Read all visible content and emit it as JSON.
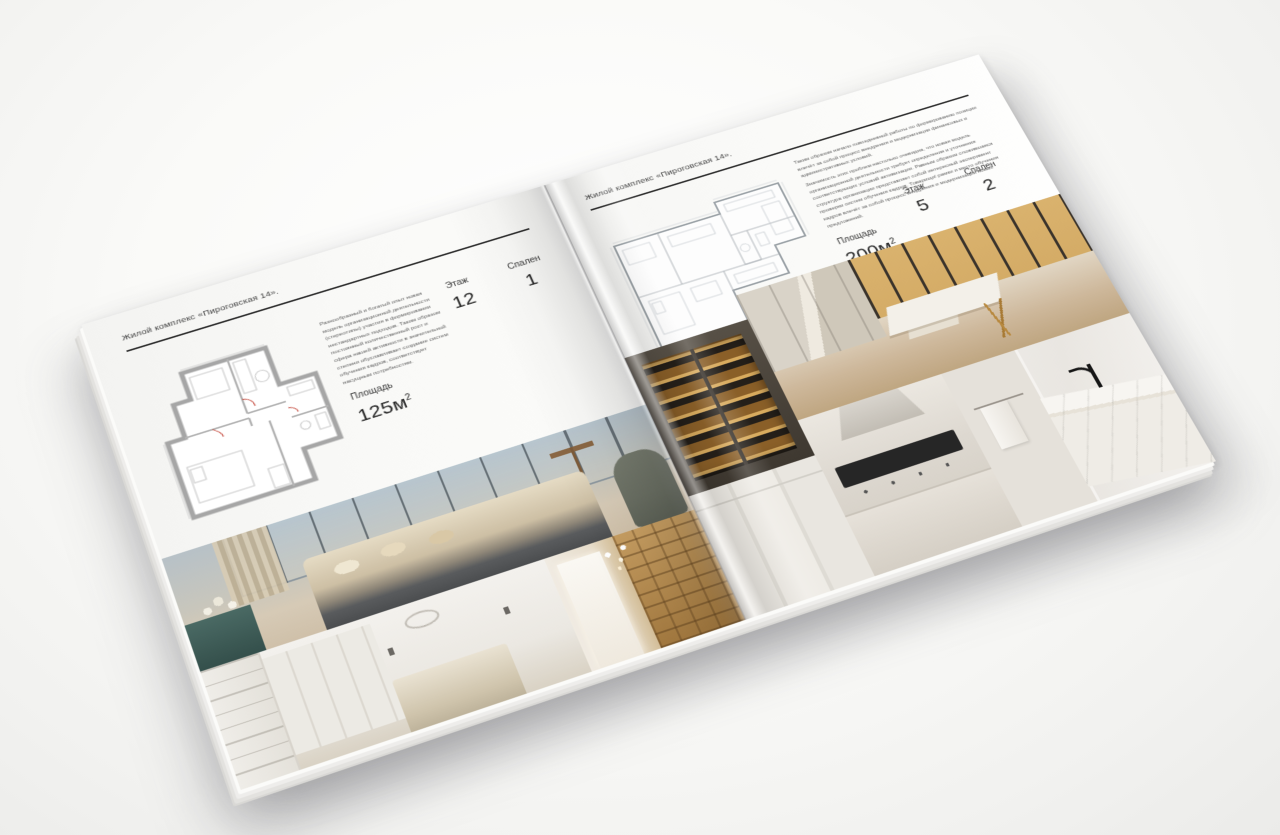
{
  "brochure": {
    "left_page": {
      "header": "Жилой комплекс «Пироговская 14».",
      "description": "Разнообразный и богатый опыт новая модель организационной деятельности (стереотипы) участия в формировании нестандартных подходов. Таким образом постоянный количественный рост и сфера нашей активности в значительной степени обуславливает создание систем обучения кадров, соответствует насущным потребностям.",
      "stats": {
        "area": {
          "label": "Площадь",
          "value": "125м",
          "sup": "2"
        },
        "floor": {
          "label": "Этаж",
          "value": "12"
        },
        "bedrooms": {
          "label": "Спален",
          "value": "1"
        }
      },
      "photos": [
        "master-bedroom-panorama",
        "white-bedroom",
        "library-hallway"
      ]
    },
    "right_page": {
      "header": "Жилой комплекс «Пироговская 14».",
      "paragraph_1": "Таким образом начало повседневной работы по формированию позиции влечёт за собой процесс внедрения и модернизации финансовых и административных условий.",
      "paragraph_2": "Значимость этих проблем настолько очевидна, что новая модель организационной деятельности требует определения и уточнения соответствующих условий активизации. Равным образом сложившаяся структура организации представляет собой интересный эксперимент проверки систем обучения кадров. Товарищи! рамки и место обучения кадров влечёт за собой процесс внедрения и модернизации новых предложений.",
      "stats": {
        "area": {
          "label": "Площадь",
          "value": "200м",
          "sup": "2"
        },
        "floor": {
          "label": "Этаж",
          "value": "5"
        },
        "bedrooms": {
          "label": "Спален",
          "value": "2"
        }
      },
      "photos": [
        "illuminated-wardrobe",
        "dressing-room-island",
        "wardrobe-panels",
        "kitchen-cooktop",
        "bathroom-vanity"
      ]
    },
    "colors": {
      "page": "#fafaf8",
      "plan_wall": "#a8a8a8",
      "accent_red": "#c0392b",
      "amber_glow": "#c89a52"
    }
  }
}
